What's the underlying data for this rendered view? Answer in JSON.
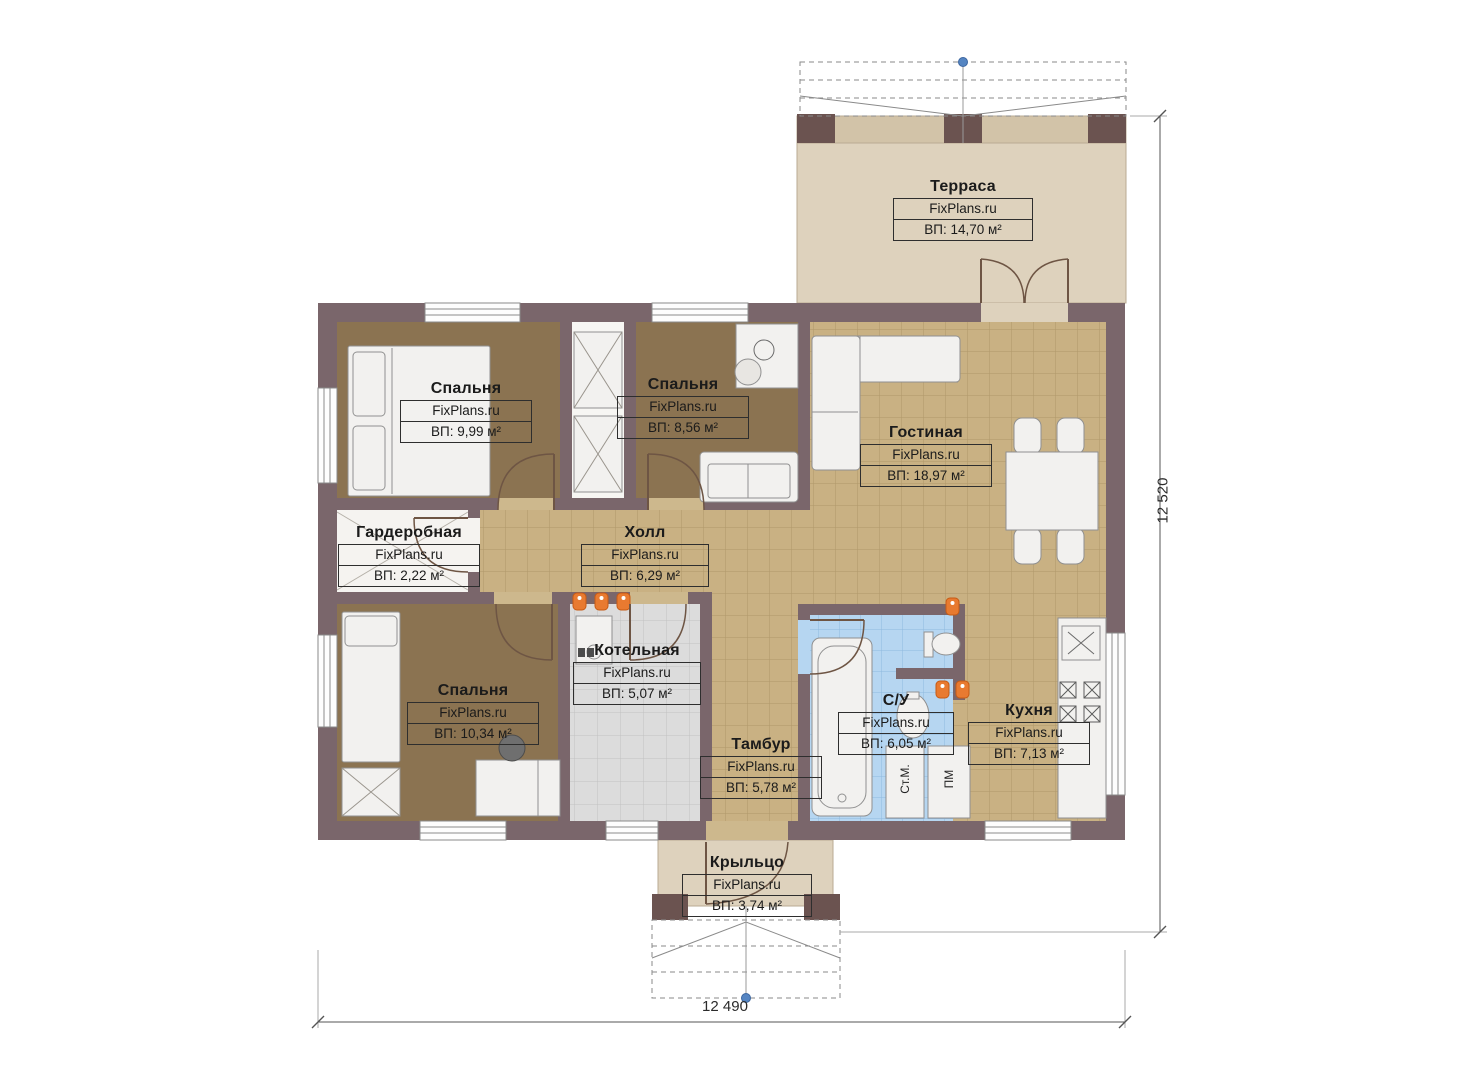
{
  "brand": "FixPlans.ru",
  "rooms": [
    {
      "key": "terrace",
      "name": "Терраса",
      "brand": "FixPlans.ru",
      "area": "ВП: 14,70 м²"
    },
    {
      "key": "bedroom-1",
      "name": "Спальня",
      "brand": "FixPlans.ru",
      "area": "ВП: 9,99 м²"
    },
    {
      "key": "bedroom-2",
      "name": "Спальня",
      "brand": "FixPlans.ru",
      "area": "ВП: 8,56 м²"
    },
    {
      "key": "living-room",
      "name": "Гостиная",
      "brand": "FixPlans.ru",
      "area": "ВП: 18,97 м²"
    },
    {
      "key": "wardrobe",
      "name": "Гардеробная",
      "brand": "FixPlans.ru",
      "area": "ВП: 2,22 м²"
    },
    {
      "key": "hall",
      "name": "Холл",
      "brand": "FixPlans.ru",
      "area": "ВП: 6,29 м²"
    },
    {
      "key": "boiler-room",
      "name": "Котельная",
      "brand": "FixPlans.ru",
      "area": "ВП: 5,07 м²"
    },
    {
      "key": "bedroom-3",
      "name": "Спальня",
      "brand": "FixPlans.ru",
      "area": "ВП: 10,34 м²"
    },
    {
      "key": "vestibule",
      "name": "Тамбур",
      "brand": "FixPlans.ru",
      "area": "ВП: 5,78 м²"
    },
    {
      "key": "bathroom",
      "name": "С/У",
      "brand": "FixPlans.ru",
      "area": "ВП: 6,05 м²"
    },
    {
      "key": "kitchen",
      "name": "Кухня",
      "brand": "FixPlans.ru",
      "area": "ВП: 7,13 м²"
    },
    {
      "key": "porch",
      "name": "Крыльцо",
      "brand": "FixPlans.ru",
      "area": "ВП: 3,74 м²"
    }
  ],
  "appliances": {
    "washing_machine": "Ст.М.",
    "dishwasher": "ПМ"
  },
  "dimensions": {
    "vertical": "12 520",
    "horizontal": "12 490"
  },
  "colors": {
    "wall": "#7a666b",
    "tile_floor": "#c9b183",
    "bedroom_floor": "#8b7351",
    "terrace_floor": "#ded2bd",
    "bathroom_tile": "#b6d6f1",
    "boiler_tile": "#dcdcdc",
    "radiator": "#e87a30",
    "axis_marker": "#5585c2"
  }
}
